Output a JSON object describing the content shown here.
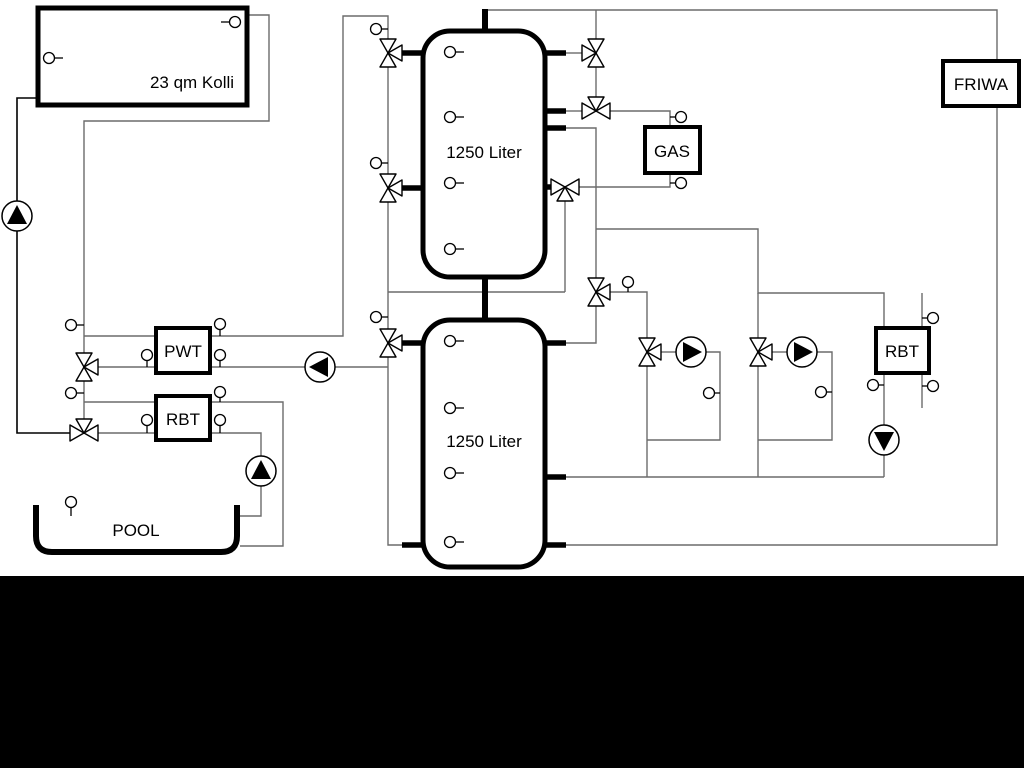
{
  "diagram": {
    "labels": {
      "collector": "23 qm Kolli",
      "tank_top": "1250 Liter",
      "tank_bottom": "1250 Liter",
      "pwt": "PWT",
      "rbt_left": "RBT",
      "gas": "GAS",
      "friwa": "FRIWA",
      "rbt_right": "RBT",
      "pool": "POOL"
    },
    "colors": {
      "pipe_gray": "#6b6b6b",
      "line_black": "#000000",
      "background": "#ffffff",
      "bottom_band": "#000000"
    },
    "icons": {
      "pump": "circle-with-solid-triangle",
      "three_way_valve": "triangle-bowtie",
      "temp_sensor": "small-circle-with-stem"
    }
  }
}
